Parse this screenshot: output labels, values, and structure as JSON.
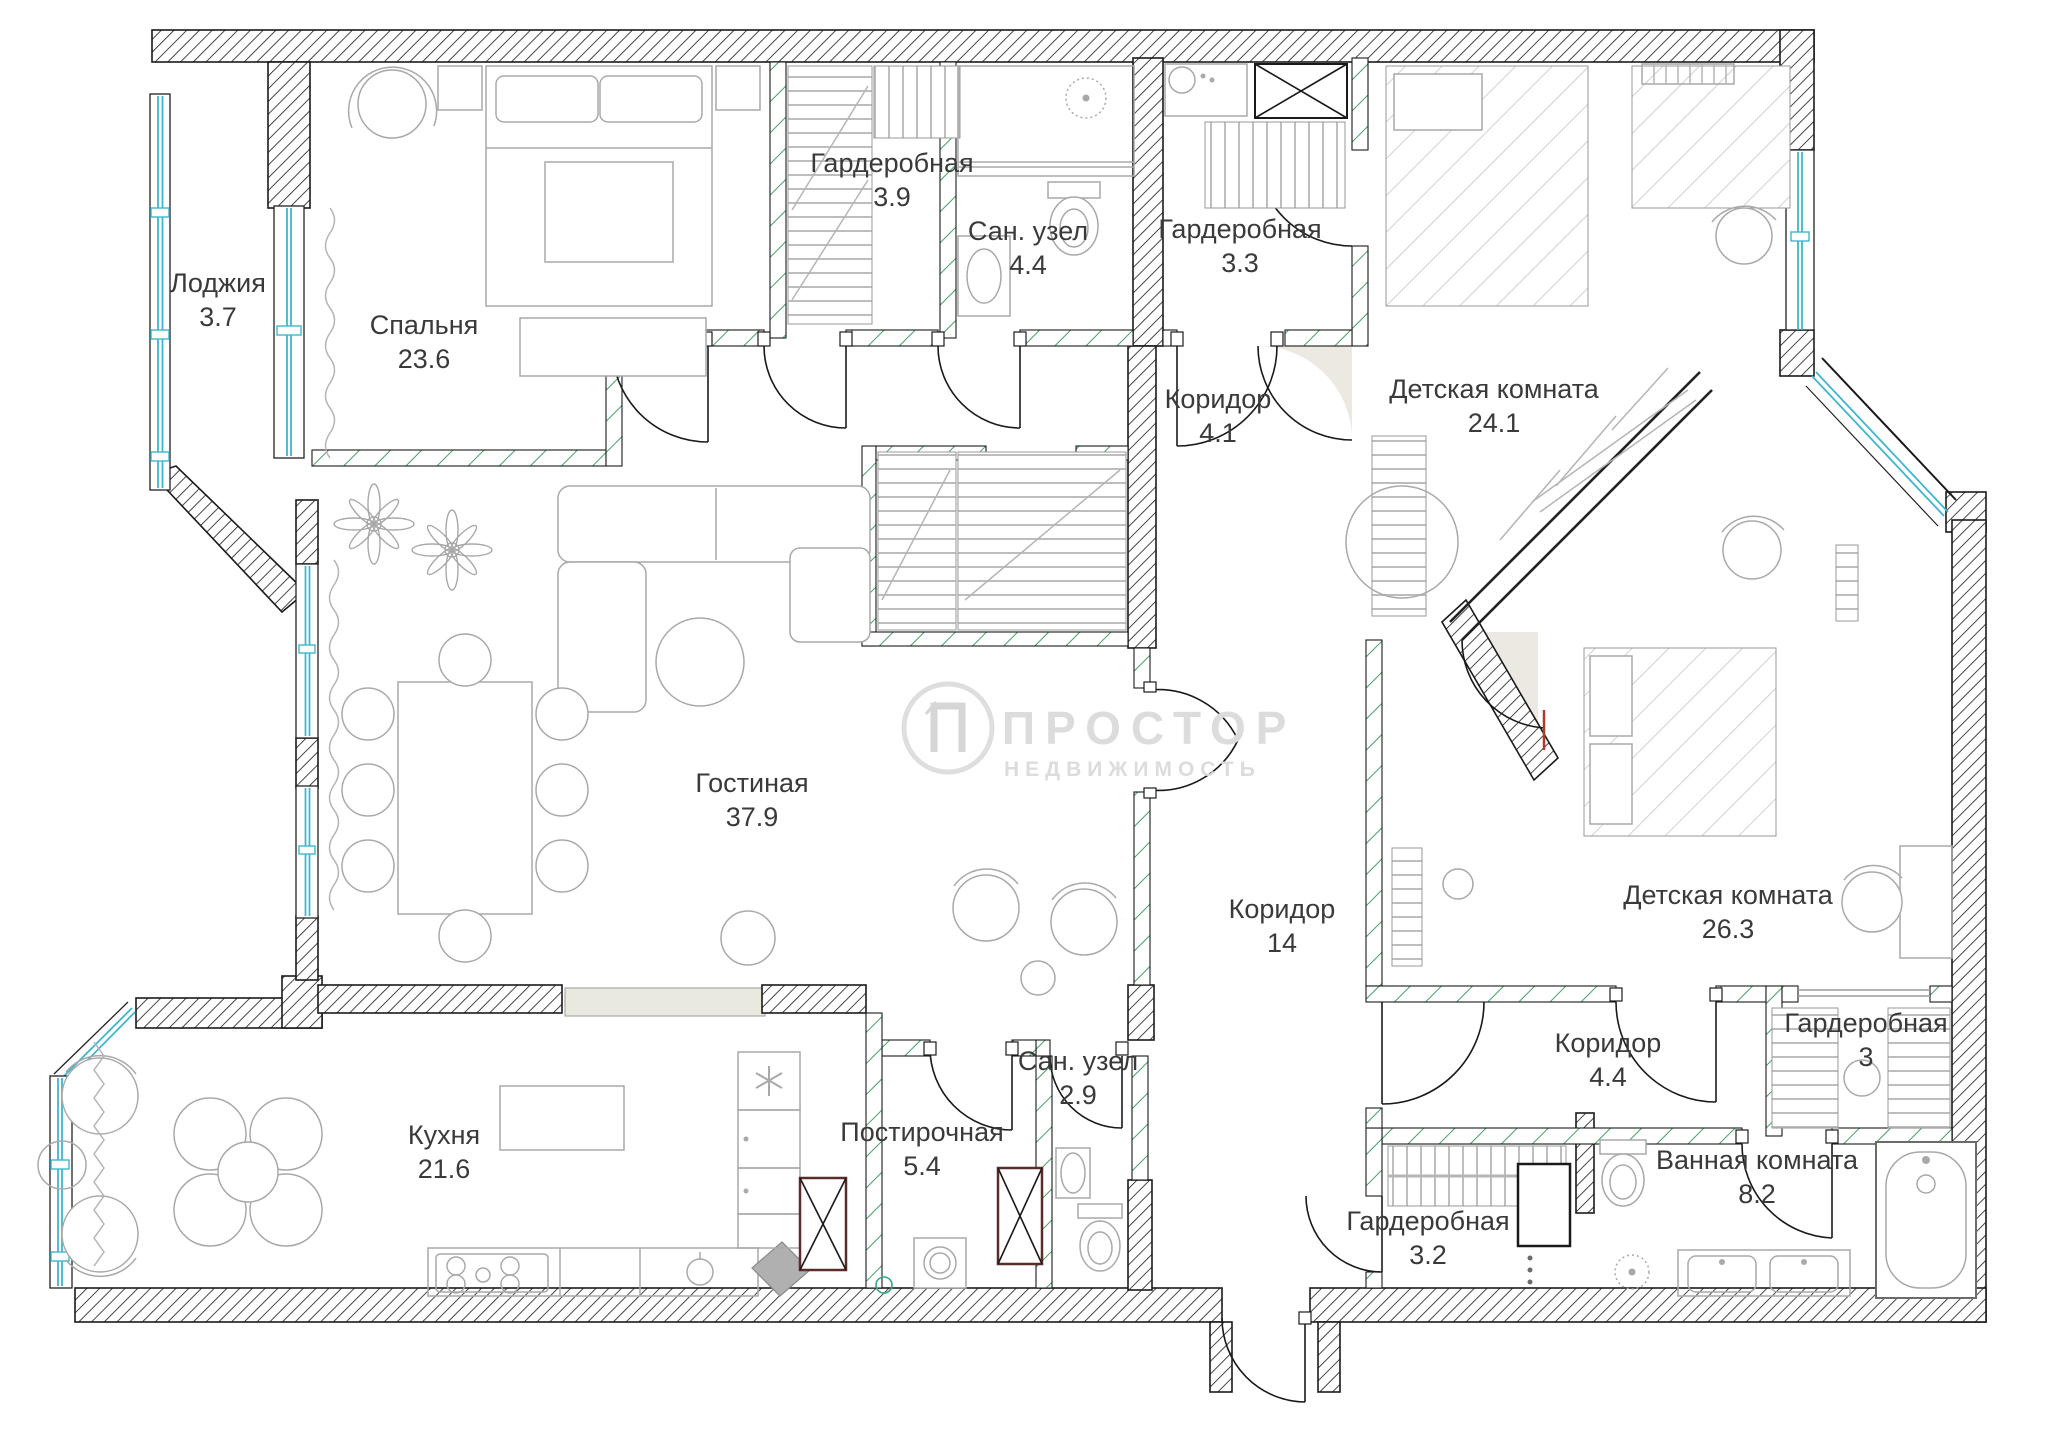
{
  "watermark": {
    "brand": "ПРОСТОР",
    "subtitle": "НЕДВИЖИМОСТЬ"
  },
  "rooms": [
    {
      "name": "Лоджия",
      "area": "3.7"
    },
    {
      "name": "Спальня",
      "area": "23.6"
    },
    {
      "name": "Гардеробная",
      "area": "3.9"
    },
    {
      "name": "Сан. узел",
      "area": "4.4"
    },
    {
      "name": "Гардеробная",
      "area": "3.3"
    },
    {
      "name": "Коридор",
      "area": "4.1"
    },
    {
      "name": "Детская комната",
      "area": "24.1"
    },
    {
      "name": "Гостиная",
      "area": "37.9"
    },
    {
      "name": "Коридор",
      "area": "14"
    },
    {
      "name": "Детская комната",
      "area": "26.3"
    },
    {
      "name": "Гардеробная",
      "area": "3"
    },
    {
      "name": "Коридор",
      "area": "4.4"
    },
    {
      "name": "Кухня",
      "area": "21.6"
    },
    {
      "name": "Постирочная",
      "area": "5.4"
    },
    {
      "name": "Сан. узел",
      "area": "2.9"
    },
    {
      "name": "Гардеробная",
      "area": "3.2"
    },
    {
      "name": "Ванная комната",
      "area": "8.2"
    }
  ],
  "colors": {
    "wall_hatch": "#262626",
    "partition_hatch": "#44a066",
    "window_glass": "#3fb6cd",
    "furniture": "#a9a9a9",
    "duct_frame": "#5a2d2a",
    "watermark": "#dcdcdc",
    "label_text": "#3a3a3a",
    "shade": "#ece9e2"
  }
}
